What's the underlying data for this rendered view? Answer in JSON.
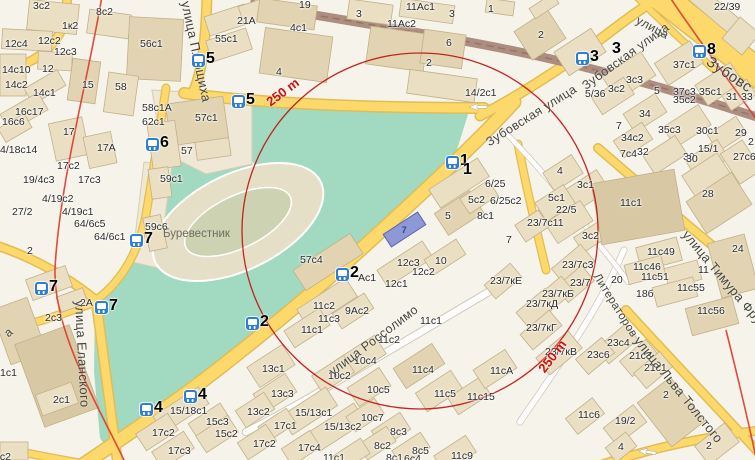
{
  "map": {
    "colors": {
      "park": "#a2d9c1",
      "road": "#fdd96b",
      "road_casing": "#e0bd55",
      "minor_road": "#ffffff",
      "minor_casing": "#cfc8b8",
      "overpass": "#ad8d80",
      "building_light": "#ebdfc3",
      "building_mid": "#e2d4b2",
      "building_dark": "#d8c9a4",
      "stop_icon": "#2e7ed5",
      "radius_line": "#c1150f",
      "boundary_line": "#dd3a2a",
      "selected_building": "#8e98d6",
      "stadium": "#e6dfc8"
    },
    "radius": {
      "text": "250 m"
    },
    "radius_labels": [
      {
        "x": 264,
        "y": 98,
        "rot": -37
      },
      {
        "x": 536,
        "y": 367,
        "rot": -53
      }
    ],
    "circle": {
      "cx": 420,
      "cy": 231,
      "r": 178
    },
    "poi": {
      "stadium": "Буревестник",
      "x": 163,
      "y": 229
    },
    "selected_building": {
      "label": "7",
      "x": 384,
      "y": 222,
      "w": 41,
      "h": 15,
      "rot": -33
    },
    "streets": [
      {
        "text": "улица Плющиха",
        "x": 192,
        "y": 0,
        "rot": 78,
        "size": 13
      },
      {
        "text": "Зубовская улица",
        "x": 484,
        "y": 138,
        "rot": -32,
        "size": 12.5
      },
      {
        "text": "Зубовская улица",
        "x": 580,
        "y": 82,
        "rot": -36,
        "size": 12.5
      },
      {
        "text": "улица",
        "x": 640,
        "y": 14,
        "rot": 28,
        "size": 12
      },
      {
        "text": "Зубовс",
        "x": 712,
        "y": 54,
        "rot": 34,
        "size": 15
      },
      {
        "text": "улица Россолимо",
        "x": 327,
        "y": 368,
        "rot": -37,
        "size": 12.5
      },
      {
        "text": "улица Еланского",
        "x": 86,
        "y": 300,
        "rot": 87,
        "size": 13
      },
      {
        "text": "улица Льва Толстого",
        "x": 642,
        "y": 334,
        "rot": 51,
        "size": 13
      },
      {
        "text": "улица Тимура Фрунзе",
        "x": 690,
        "y": 228,
        "rot": 50,
        "size": 13
      },
      {
        "text": "Литераторов",
        "x": 600,
        "y": 272,
        "rot": 58,
        "size": 11.5
      },
      {
        "text": "а",
        "x": 2,
        "y": 330,
        "rot": -40,
        "size": 12
      }
    ],
    "stops": [
      {
        "n": "1",
        "x": 446,
        "y": 156,
        "icon": true
      },
      {
        "n": "1",
        "x": 463,
        "y": 165,
        "icon": false
      },
      {
        "n": "2",
        "x": 336,
        "y": 268,
        "icon": true
      },
      {
        "n": "2",
        "x": 246,
        "y": 317,
        "icon": true
      },
      {
        "n": "3",
        "x": 576,
        "y": 52,
        "icon": true
      },
      {
        "n": "3",
        "x": 612,
        "y": 44,
        "icon": false
      },
      {
        "n": "8",
        "x": 693,
        "y": 45,
        "icon": true
      },
      {
        "n": "5",
        "x": 192,
        "y": 54,
        "icon": true
      },
      {
        "n": "5",
        "x": 232,
        "y": 95,
        "icon": true
      },
      {
        "n": "6",
        "x": 146,
        "y": 138,
        "icon": true
      },
      {
        "n": "7",
        "x": 130,
        "y": 234,
        "icon": true
      },
      {
        "n": "7",
        "x": 35,
        "y": 282,
        "icon": true
      },
      {
        "n": "7",
        "x": 95,
        "y": 301,
        "icon": true
      },
      {
        "n": "4",
        "x": 140,
        "y": 403,
        "icon": true
      },
      {
        "n": "4",
        "x": 184,
        "y": 390,
        "icon": true
      }
    ],
    "buildings": [
      [
        "3с2",
        33,
        1
      ],
      [
        "8с2",
        96,
        7
      ],
      [
        "1к2",
        62,
        21
      ],
      [
        "12с4",
        5,
        39
      ],
      [
        "12с2",
        38,
        36
      ],
      [
        "12с3",
        54,
        47
      ],
      [
        "12",
        42,
        64
      ],
      [
        "14с10",
        2,
        65
      ],
      [
        "14с2",
        5,
        80
      ],
      [
        "14с1",
        33,
        88
      ],
      [
        "15",
        82,
        80
      ],
      [
        "58",
        115,
        82
      ],
      [
        "56с1",
        140,
        39
      ],
      [
        "55с1",
        215,
        34
      ],
      [
        "21А",
        237,
        16
      ],
      [
        "16с17",
        15,
        107
      ],
      [
        "16с6",
        2,
        117
      ],
      [
        "17",
        63,
        127
      ],
      [
        "58с1А",
        142,
        103
      ],
      [
        "62с1",
        142,
        117
      ],
      [
        "57с1",
        195,
        113
      ],
      [
        "57",
        181,
        146
      ],
      [
        "17А",
        97,
        143
      ],
      [
        "4/18с14",
        0,
        145
      ],
      [
        "19",
        299,
        0
      ],
      [
        "3",
        356,
        9
      ],
      [
        "4с1",
        290,
        23
      ],
      [
        "11Ас1",
        406,
        2
      ],
      [
        "11Ас2",
        387,
        19
      ],
      [
        "3",
        449,
        9
      ],
      [
        "6",
        446,
        38
      ],
      [
        "2",
        426,
        58
      ],
      [
        "4",
        276,
        67
      ],
      [
        "1",
        488,
        4
      ],
      [
        "14/2с1",
        465,
        88
      ],
      [
        "2",
        538,
        30
      ],
      [
        "22/39",
        714,
        2
      ],
      [
        "3с3",
        626,
        75
      ],
      [
        "3с2",
        608,
        84
      ],
      [
        "5/36",
        585,
        89
      ],
      [
        "5",
        654,
        86
      ],
      [
        "37с1",
        673,
        60
      ],
      [
        "37с3",
        673,
        87
      ],
      [
        "35с1",
        699,
        87
      ],
      [
        "35с2",
        673,
        95
      ],
      [
        "31",
        726,
        92
      ],
      [
        "33",
        741,
        92
      ],
      [
        "34",
        639,
        109
      ],
      [
        "7",
        616,
        121
      ],
      [
        "35с3",
        658,
        125
      ],
      [
        "30с1",
        696,
        126
      ],
      [
        "29",
        735,
        128
      ],
      [
        "2",
        748,
        137
      ],
      [
        "34с2",
        621,
        133
      ],
      [
        "32",
        637,
        147
      ],
      [
        "30",
        683,
        152
      ],
      [
        "27с6",
        733,
        152
      ],
      [
        "15/1",
        698,
        144
      ],
      [
        "7с4",
        620,
        149
      ],
      [
        "4",
        557,
        166
      ],
      [
        "3с1",
        577,
        180
      ],
      [
        "5с1",
        548,
        193
      ],
      [
        "22/5",
        556,
        205
      ],
      [
        "23/7с11",
        527,
        218
      ],
      [
        "7",
        506,
        235
      ],
      [
        "11с1",
        620,
        198
      ],
      [
        "30",
        686,
        154
      ],
      [
        "28",
        702,
        189
      ],
      [
        "24",
        732,
        244
      ],
      [
        "11с49",
        647,
        247
      ],
      [
        "11с46",
        633,
        262
      ],
      [
        "11с51",
        641,
        272
      ],
      [
        "11",
        698,
        265
      ],
      [
        "11с55",
        677,
        283
      ],
      [
        "18б",
        636,
        289
      ],
      [
        "20",
        611,
        275
      ],
      [
        "3с2",
        582,
        231
      ],
      [
        "23/7с3",
        562,
        260
      ],
      [
        "23/7",
        570,
        278
      ],
      [
        "23/7кБ",
        542,
        289
      ],
      [
        "23/7кД",
        526,
        299
      ],
      [
        "23/7кЕ",
        490,
        276
      ],
      [
        "11с56",
        697,
        306
      ],
      [
        "23/7кГ",
        526,
        323
      ],
      [
        "23/7кВ",
        545,
        347
      ],
      [
        "5",
        445,
        211
      ],
      [
        "5с2",
        468,
        195
      ],
      [
        "6/25",
        485,
        179
      ],
      [
        "6/25с2",
        490,
        196
      ],
      [
        "8с1",
        477,
        211
      ],
      [
        "57с4",
        300,
        255
      ],
      [
        "12с3",
        397,
        258
      ],
      [
        "12с2",
        412,
        267
      ],
      [
        "12с1",
        385,
        279
      ],
      [
        "10",
        435,
        256
      ],
      [
        "Ас1",
        358,
        273
      ],
      [
        "59с1",
        160,
        174
      ],
      [
        "59с6",
        145,
        222
      ],
      [
        "64/6с5",
        74,
        219
      ],
      [
        "64/6с1",
        94,
        232
      ],
      [
        "2",
        27,
        246
      ],
      [
        "19/4с3",
        23,
        175
      ],
      [
        "17с3",
        78,
        175
      ],
      [
        "17с2",
        57,
        161
      ],
      [
        "4/19с2",
        42,
        194
      ],
      [
        "4/19с1",
        62,
        207
      ],
      [
        "27/2",
        12,
        207
      ],
      [
        "2с3",
        45,
        313
      ],
      [
        "2А",
        80,
        298
      ],
      [
        "1с1",
        0,
        368
      ],
      [
        "2с1",
        53,
        395
      ],
      [
        "2с2",
        -6,
        452
      ],
      [
        "15/18с1",
        170,
        406
      ],
      [
        "15с3",
        206,
        417
      ],
      [
        "15с2",
        215,
        429
      ],
      [
        "17с2",
        152,
        428
      ],
      [
        "17с3",
        168,
        446
      ],
      [
        "11с2",
        313,
        301
      ],
      [
        "11с3",
        318,
        314
      ],
      [
        "9Ас2",
        345,
        306
      ],
      [
        "11с1",
        301,
        325
      ],
      [
        "11с1",
        420,
        316
      ],
      [
        "11с2",
        378,
        335
      ],
      [
        "13с1",
        262,
        364
      ],
      [
        "13с3",
        271,
        389
      ],
      [
        "13с2",
        247,
        407
      ],
      [
        "10с4",
        354,
        356
      ],
      [
        "10с2",
        328,
        371
      ],
      [
        "10с5",
        367,
        385
      ],
      [
        "11с4",
        412,
        365
      ],
      [
        "11с5",
        434,
        389
      ],
      [
        "11с15",
        467,
        392
      ],
      [
        "11сА",
        490,
        366
      ],
      [
        "15/13с1",
        295,
        408
      ],
      [
        "15/13с2",
        324,
        422
      ],
      [
        "10с7",
        361,
        413
      ],
      [
        "17с1",
        274,
        421
      ],
      [
        "17с2",
        253,
        439
      ],
      [
        "17с4",
        298,
        443
      ],
      [
        "8с3",
        390,
        427
      ],
      [
        "8с2",
        374,
        441
      ],
      [
        "8с5",
        412,
        446
      ],
      [
        "8с1",
        386,
        453
      ],
      [
        "6с4",
        404,
        454
      ],
      [
        "11с1",
        323,
        453
      ],
      [
        "11с9",
        451,
        451
      ],
      [
        "23с4",
        607,
        338
      ],
      [
        "23с6",
        587,
        350
      ],
      [
        "21с3",
        629,
        351
      ],
      [
        "21с1",
        644,
        363
      ],
      [
        "2",
        663,
        390
      ],
      [
        "11с6",
        578,
        410
      ],
      [
        "19/2",
        615,
        416
      ],
      [
        "4",
        618,
        442
      ],
      [
        "2",
        706,
        441
      ]
    ]
  }
}
